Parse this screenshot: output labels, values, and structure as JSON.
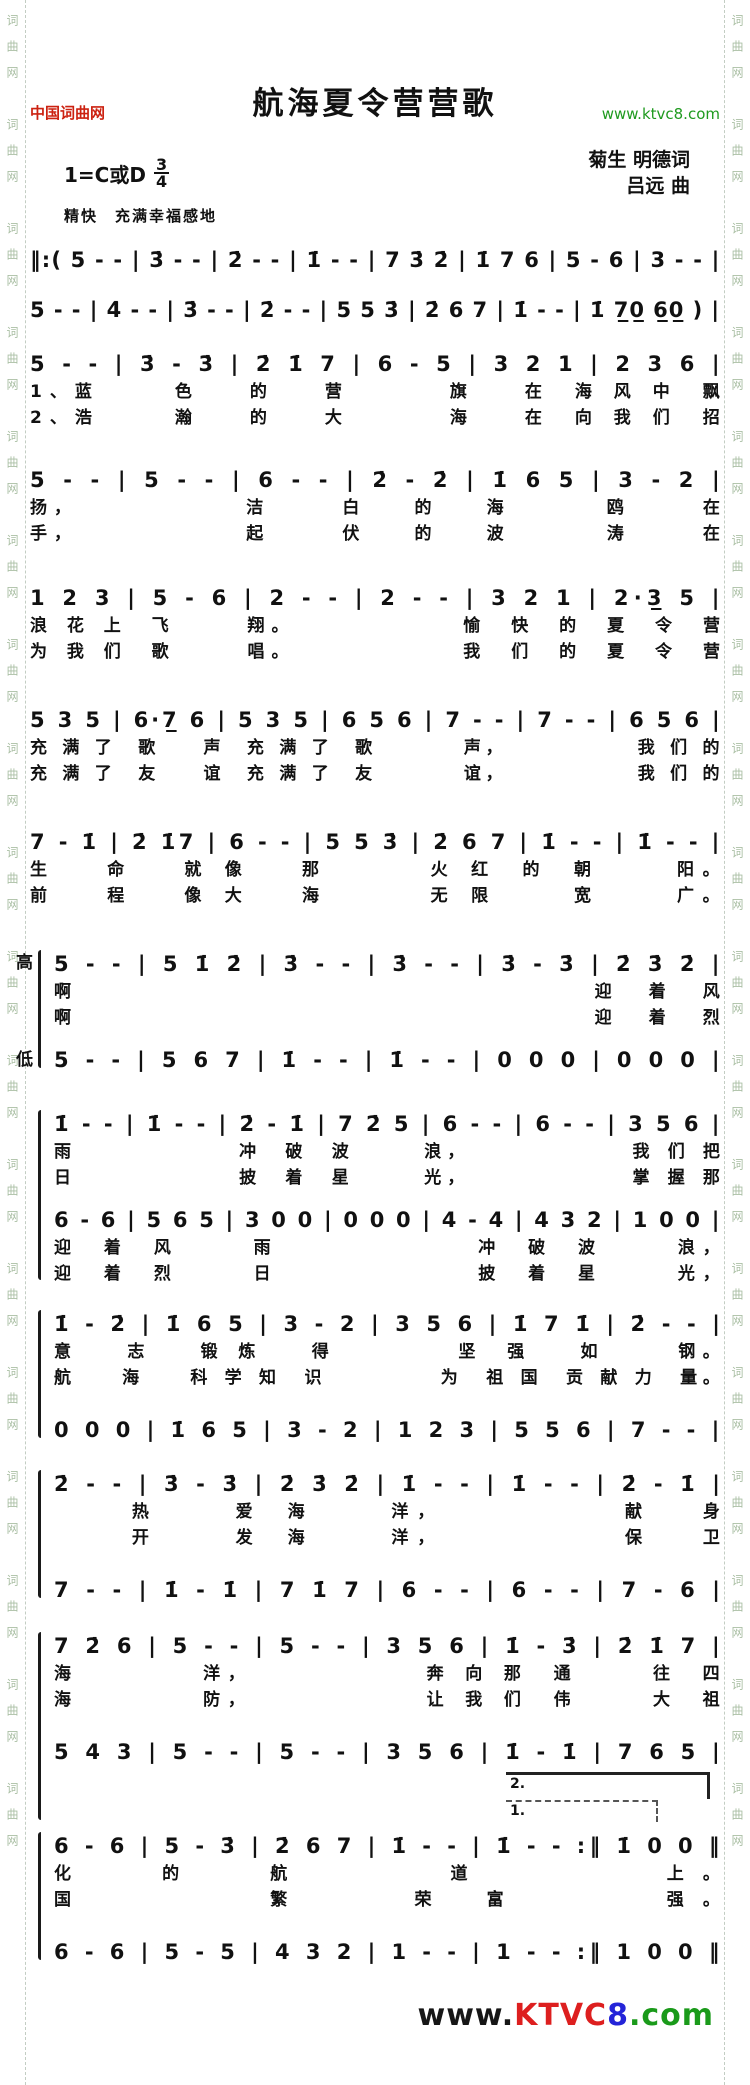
{
  "colors": {
    "site_red": "#cc2211",
    "url_green": "#1f9a1f",
    "logo_red": "#dd1f1f",
    "logo_blue": "#2424d8",
    "logo_green": "#1a9a1a",
    "rail_gray_green": "#aabfa4",
    "ink": "#111111"
  },
  "rail_text": "词曲网　词曲网　词曲网　词曲网　词曲网　词曲网　词曲网　词曲网　词曲网　词曲网　词曲网　词曲网　词曲网　词曲网　词曲网　词曲网　词曲网　词曲网",
  "header": {
    "site_left": "中国词曲网",
    "title": "航海夏令营营歌",
    "site_right": "www.ktvc8.com"
  },
  "meta": {
    "key_signature": "1=C或D",
    "time_top": "3",
    "time_bottom": "4",
    "tempo": "精快　充满幸福感地",
    "lyricist": "菊生 明德词",
    "composer": "吕远 曲"
  },
  "voice_labels": {
    "high": "高",
    "low": "低"
  },
  "volta": {
    "second": "2.",
    "first": "1."
  },
  "music": {
    "s1": {
      "notation": "‖:( 5 - - | 3̇ - - | 2̇ - - | 1̇ - - | 7 3̇ 2̇ | 1̇ 7 6 | 5 - 6 | 3 - - |"
    },
    "s2": {
      "notation": "5 - - | 4̇ - - | 3̇ - - | 2̇ - - | 5 5 3̇ | 2̇ 6 7 | 1̇ - - | 1̇ 7̲0̲ 6̲0̲ ) |"
    },
    "s3": {
      "notation": "5 - - | 3̇ - 3̇ | 2̇ 1̇ 7 | 6 - 5 | 3 2 1 | 2 3 6 |",
      "lyrics": [
        "1、蓝　　　色　　的　　营　　　　旗　　在　海 风 中　飘",
        "2、浩　　　瀚　　的　　大　　　　海　　在　向 我 们　招"
      ]
    },
    "s4": {
      "notation": "5 - - | 5 - - | 6 - - | 2̇ - 2̇ | 1̇ 6 5 | 3 - 2 |",
      "lyrics": [
        "扬，　　　　　　　洁　　　白　　的　　海　　　　鸥　　　在",
        "手，　　　　　　　起　　　伏　　的　　波　　　　涛　　　在"
      ]
    },
    "s5": {
      "notation": "1 2 3 | 5 - 6 | 2 - - | 2 - - | 3 2 1 | 2·3̲ 5 |",
      "lyrics": [
        "浪 花 上　飞　　　翔。　　　　　　　愉　快　的　夏　令　营",
        "为 我 们　歌　　　唱。　　　　　　　我　们　的　夏　令　营"
      ]
    },
    "s6": {
      "notation": "5 3 5 | 6·7̲ 6 | 5 3 5 | 6 5 6 | 7 - - | 7 - - | 6 5 6 |",
      "lyrics": [
        "充 满 了　歌　　声　充 满 了　歌　　　　声，　　　　　　我 们 的",
        "充 满 了　友　　谊　充 满 了　友　　　　谊，　　　　　　我 们 的"
      ]
    },
    "s7": {
      "notation": "7 - 1̇ | 2̇ 1̇7 | 6 - - | 5 5 3̇ | 2̇ 6 7 | 1̇ - - | 1̇ - - |",
      "lyrics": [
        "生　　命　　就 像　　那　　　　火 红　的　朝　　　阳。",
        "前　　程　　像 大　　海　　　　无 限　　　宽　　　广。"
      ]
    },
    "s8": {
      "high": {
        "notation": "5 - - | 5 1̇ 2̇ | 3̇ - - | 3̇ - - | 3̇ - 3̇ | 2̇ 3̇ 2̇ |",
        "lyrics": [
          "啊　　　　　　　　　　　　　　　　　　　迎　着　风",
          "啊　　　　　　　　　　　　　　　　　　　迎　着　烈"
        ]
      },
      "low": {
        "notation": "5 - - | 5 6 7 | 1̇ - - | 1̇ - - | 0 0 0 | 0 0 0 |"
      }
    },
    "s9": {
      "high": {
        "notation": "1̇ - - | 1̇ - - | 2̇ - 1̇ | 7 2̇ 5 | 6 - - | 6 - - | 3 5 6 |",
        "lyrics": [
          "雨　　　　　　　冲　破　波　　　浪，　　　　　　　我 们 把",
          "日　　　　　　　披　着　星　　　光，　　　　　　　掌 握 那"
        ]
      },
      "low": {
        "notation": "6 - 6 | 5 6 5 | 3 0 0 | 0 0 0 | 4 - 4 | 4 3 2 | 1 0 0 |",
        "lyrics": [
          "迎　着　风　　　雨　　　　　　　　冲　破　波　　　浪，",
          "迎　着　烈　　　日　　　　　　　　披　着　星　　　光，"
        ]
      }
    },
    "s10": {
      "notation": "1̇ - 2̇ | 1̇ 6 5 | 3 - 2 | 3 5 6 | 1̇ 7 1̇ | 2̇ - - |",
      "lyrics": [
        "意　　志　　锻 炼　　得　　　　　坚　强　　如　　　钢。",
        "航　　海　　科 学 知　识　　　　　为　祖 国　贡 献 力　量。"
      ]
    },
    "s11": {
      "notation": "0 0 0 | 1̇ 6 5 | 3 - 2 | 1 2 3 | 5 5 6 | 7 - - |"
    },
    "s12": {
      "notation": "2̇ - - | 3̇ - 3̇ | 2̇ 3̇ 2̇ | 1̇ - - | 1̇ - - | 2̇ - 1̇ |",
      "lyrics": [
        "　　　热　　　爱　海　　　洋，　　　　　　　献　　身",
        "　　　开　　　发　海　　　洋，　　　　　　　保　　卫"
      ]
    },
    "s13": {
      "notation": "7 - - | 1̇ - 1̇ | 7 1̇ 7 | 6 - - | 6 - - | 7 - 6 |"
    },
    "s14": {
      "notation": "7 2̇ 6 | 5 - - | 5 - - | 3 5 6 | 1̇ - 3̇ | 2̇ 1̇ 7 |",
      "lyrics": [
        "海　　　　　洋，　　　　　　　奔 向 那　通　　　往　四",
        "海　　　　　防，　　　　　　　让 我 们　伟　　　大　祖"
      ]
    },
    "s15": {
      "notation": "5 4 3 | 5 - - | 5 - - | 3 5 6 | 1̇ - 1̇ | 7 6 5 |"
    },
    "s16": {
      "notation": "6 - 6 | 5 - 3̇ | 2̇ 6 7 | 1̇ - - | 1̇ - - :‖ 1̇ 0 0 ‖",
      "lyrics": [
        "化　　的　　航　　　　道　　　　　上。",
        "国　　　　　繁　　　荣　富　　　　强。"
      ]
    },
    "s17": {
      "notation": "6 - 6 | 5 - 5 | 4 3 2 | 1 - - | 1 - - :‖ 1 0 0 ‖"
    }
  },
  "footer": {
    "www": "www.",
    "ktvc": "KTVC",
    "eight": "8",
    "com": ".com"
  }
}
